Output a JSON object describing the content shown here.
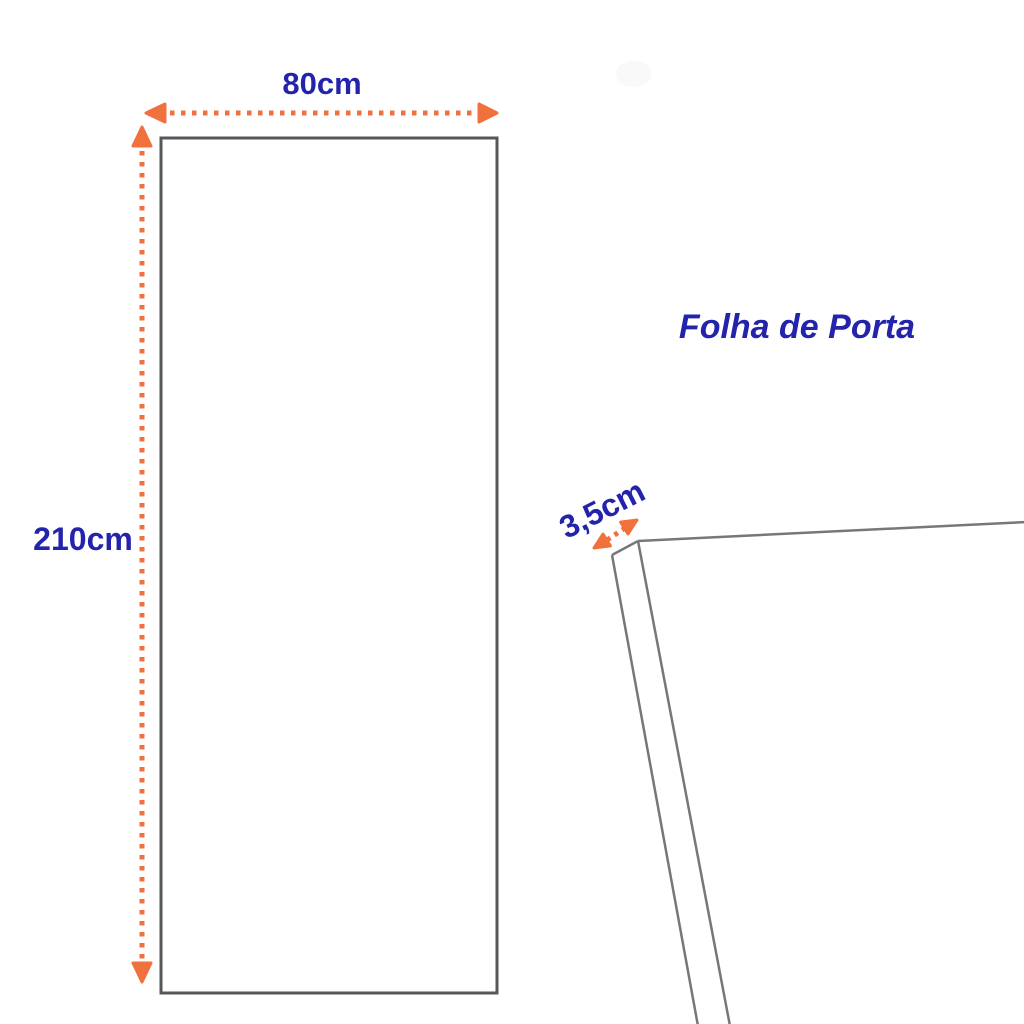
{
  "title": "Folha de Porta",
  "door_front": {
    "width_label": "80cm",
    "height_label": "210cm"
  },
  "door_edge": {
    "thickness_label": "3,5cm"
  },
  "colors": {
    "label_text": "#2323AC",
    "dimension_arrow": "#F0713E",
    "door_outline": "#54575B",
    "edge_outline": "#76777B"
  }
}
